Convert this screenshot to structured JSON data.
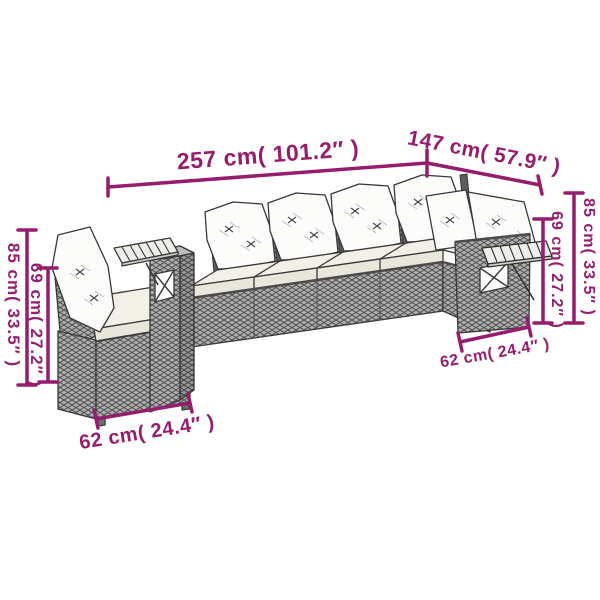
{
  "image": {
    "type": "product-dimension-diagram",
    "subject": "Poly rattan L-shaped garden lounge set line drawing with white cushions and wooden side trays",
    "background": "#ffffff"
  },
  "colors": {
    "dimension_accent": "#961d6e",
    "outline": "#383838",
    "wicker_gray": "#b0b0b0",
    "wicker_weave": "#4f4f4f",
    "cushion_white": "#fcfcfb",
    "seat_cream": "#f3f1e7",
    "wood_slat": "#ededea"
  },
  "dimensions": {
    "top_width": "257 cm( 101.2″ )",
    "right_depth": "147 cm( 57.9″ )",
    "left_total_height": "85 cm( 33.5″ )",
    "left_back_height": "69 cm( 27.2″ )",
    "right_total_height": "85 cm( 33.5″ )",
    "right_back_height": "69 cm( 27.2″ )",
    "bottom_left_seat_width": "62 cm( 24.4″ )",
    "bottom_right_seat_width": "62 cm( 24.4″ )"
  }
}
